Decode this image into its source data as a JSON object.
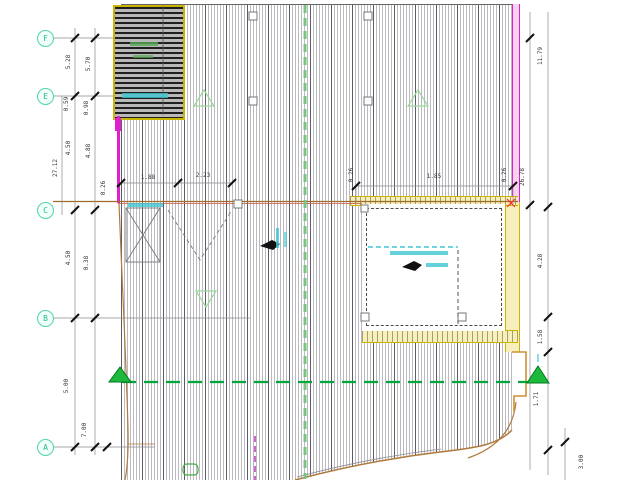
{
  "plan": {
    "type": "architectural-roof-plan",
    "grid_bubbles": [
      {
        "label": "F"
      },
      {
        "label": "E"
      },
      {
        "label": "C"
      },
      {
        "label": "B"
      },
      {
        "label": "A"
      }
    ],
    "dimensions": [
      {
        "text": "5.28"
      },
      {
        "text": "5.70"
      },
      {
        "text": "0.59"
      },
      {
        "text": "0.98"
      },
      {
        "text": "4.50"
      },
      {
        "text": "4.88"
      },
      {
        "text": "27.12"
      },
      {
        "text": "0.26"
      },
      {
        "text": "1.88"
      },
      {
        "text": "2.23"
      },
      {
        "text": "4.50"
      },
      {
        "text": "0.38"
      },
      {
        "text": "5.00"
      },
      {
        "text": "7.00"
      },
      {
        "text": "0.26"
      },
      {
        "text": "1.85"
      },
      {
        "text": "0.26"
      },
      {
        "text": "11.79"
      },
      {
        "text": "26.78"
      },
      {
        "text": "4.28"
      },
      {
        "text": "1.58"
      },
      {
        "text": "1.71"
      },
      {
        "text": "3.00"
      }
    ],
    "symbols": {
      "section_marker": "filled-green-triangle",
      "slope_indicator": "hollow-green-triangle",
      "roof_opening": "small-hollow-square",
      "flow_symbol": "filled-black-blob",
      "bracing": "x-cross-hatched-box"
    },
    "colors": {
      "deck_line": "#787884",
      "hatch_dark": "#1f1f1f",
      "yellow_wall": "#c9b402",
      "magenta_wall": "#e020d0",
      "grid_bubble_green": "#4fd6a8",
      "section_green": "#1db93c",
      "slope_green": "#9bd89b",
      "cyan_note": "#3ec6d2",
      "edge_tan": "#b07a3c",
      "dim_text": "#3a3a3a"
    }
  }
}
